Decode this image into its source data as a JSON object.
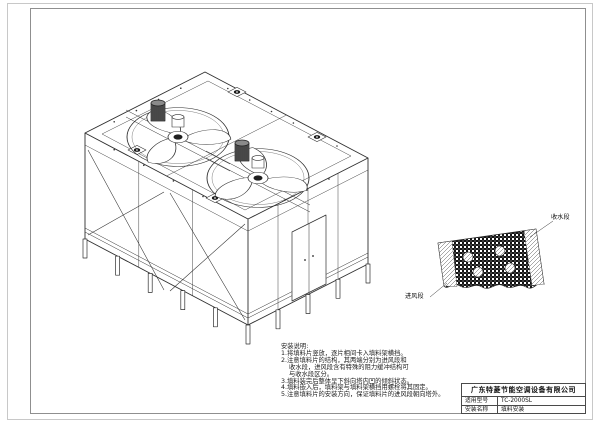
{
  "title_block": {
    "company": "广东特菱节能空调设备有限公司",
    "model_label": "适用型号",
    "model_value": "TC-2000SL",
    "name_label": "安装名称",
    "name_value": "填料安装"
  },
  "notes": {
    "heading": "安装说明:",
    "lines": [
      "1.将填料片竖放，逐片相间卡入填料架横挡。",
      "2.注意填料片的结构，其两端分别为进风段和",
      "收水段，进风段含有特殊的阻力缓冲结构可",
      "与收水段区分。",
      "3.填料装完后整体呈下斜向塔内凹的倾斜状态。",
      "4.填料嵌入后，填料架与填料架横挡用螺栓将其固定。",
      "5.注意填料片的安装方向，保证填料片的进风段朝向塔外。"
    ]
  },
  "detail": {
    "label_water": "收水段",
    "label_air": "进风段"
  },
  "colors": {
    "line": "#2f2f2f",
    "frame_inner": "#8f8f8f",
    "frame_outer": "#c8c8c8",
    "fill_dark": "#111111"
  }
}
